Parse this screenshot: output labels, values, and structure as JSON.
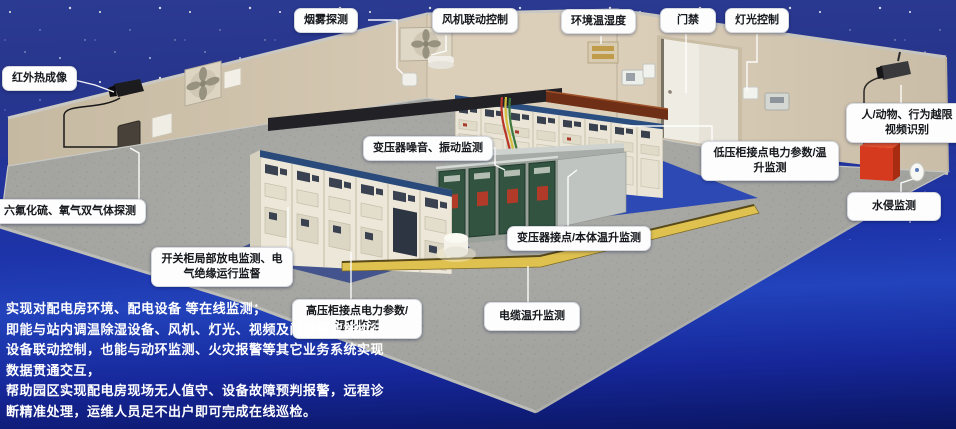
{
  "callouts": [
    {
      "id": "smoke-detection",
      "text": "烟雾探测"
    },
    {
      "id": "fan-linkage-control",
      "text": "风机联动控制"
    },
    {
      "id": "env-temp-humidity",
      "text": "环境温湿度"
    },
    {
      "id": "access-control",
      "text": "门禁"
    },
    {
      "id": "lighting-control",
      "text": "灯光控制"
    },
    {
      "id": "infrared-thermal-imaging",
      "text": "红外热成像"
    },
    {
      "id": "sf6-o2-gas-detection",
      "text": "六氟化硫、氧气双气体探测"
    },
    {
      "id": "person-animal-video-recognition",
      "text": "人/动物、行为越限视频识别"
    },
    {
      "id": "water-intrusion-monitoring",
      "text": "水侵监测"
    },
    {
      "id": "transformer-noise-vibration",
      "text": "变压器噪音、振动监测"
    },
    {
      "id": "lv-cabinet-power-temp",
      "text": "低压柜接点电力参数/温升监测"
    },
    {
      "id": "transformer-contact-temp",
      "text": "变压器接点/本体温升监测"
    },
    {
      "id": "switchgear-partial-discharge",
      "text": "开关柜局部放电监测、电气绝缘运行监督"
    },
    {
      "id": "hv-cabinet-power-temp",
      "text": "高压柜接点电力参数/温升监测"
    },
    {
      "id": "cable-temp-monitoring",
      "text": "电缆温升监测"
    }
  ],
  "description": {
    "lines": [
      "实现对配电房环境、配电设备 等在线监测；",
      "即能与站内调温除湿设备、风机、灯光、视频及门禁等智能执行",
      "设备联动控制，也能与动环监测、火灾报警等其它业务系统实现",
      "数据贯通交互，",
      "帮助园区实现配电房现场无人值守、设备故障预判报警，远程诊",
      "断精准处理，运维人员足不出户即可完成在线巡检。"
    ]
  },
  "colors": {
    "background_blue": "#1d33a8",
    "sky_navy": "#2c3b92",
    "wall_beige": "#d3c7b1",
    "floor_gray": "#9e9e9a",
    "hv_mat_blue": "#42538d",
    "lv_mat_blue": "#2d49b4",
    "cabinet_cream": "#eae5d6",
    "transformer_green": "#315340",
    "duct_yellow": "#dfc14f",
    "alarm_red": "#d63a1e",
    "callout_bg": "#fdfdfd",
    "leader_line": "#ffffff",
    "text_white": "#ffffff"
  }
}
